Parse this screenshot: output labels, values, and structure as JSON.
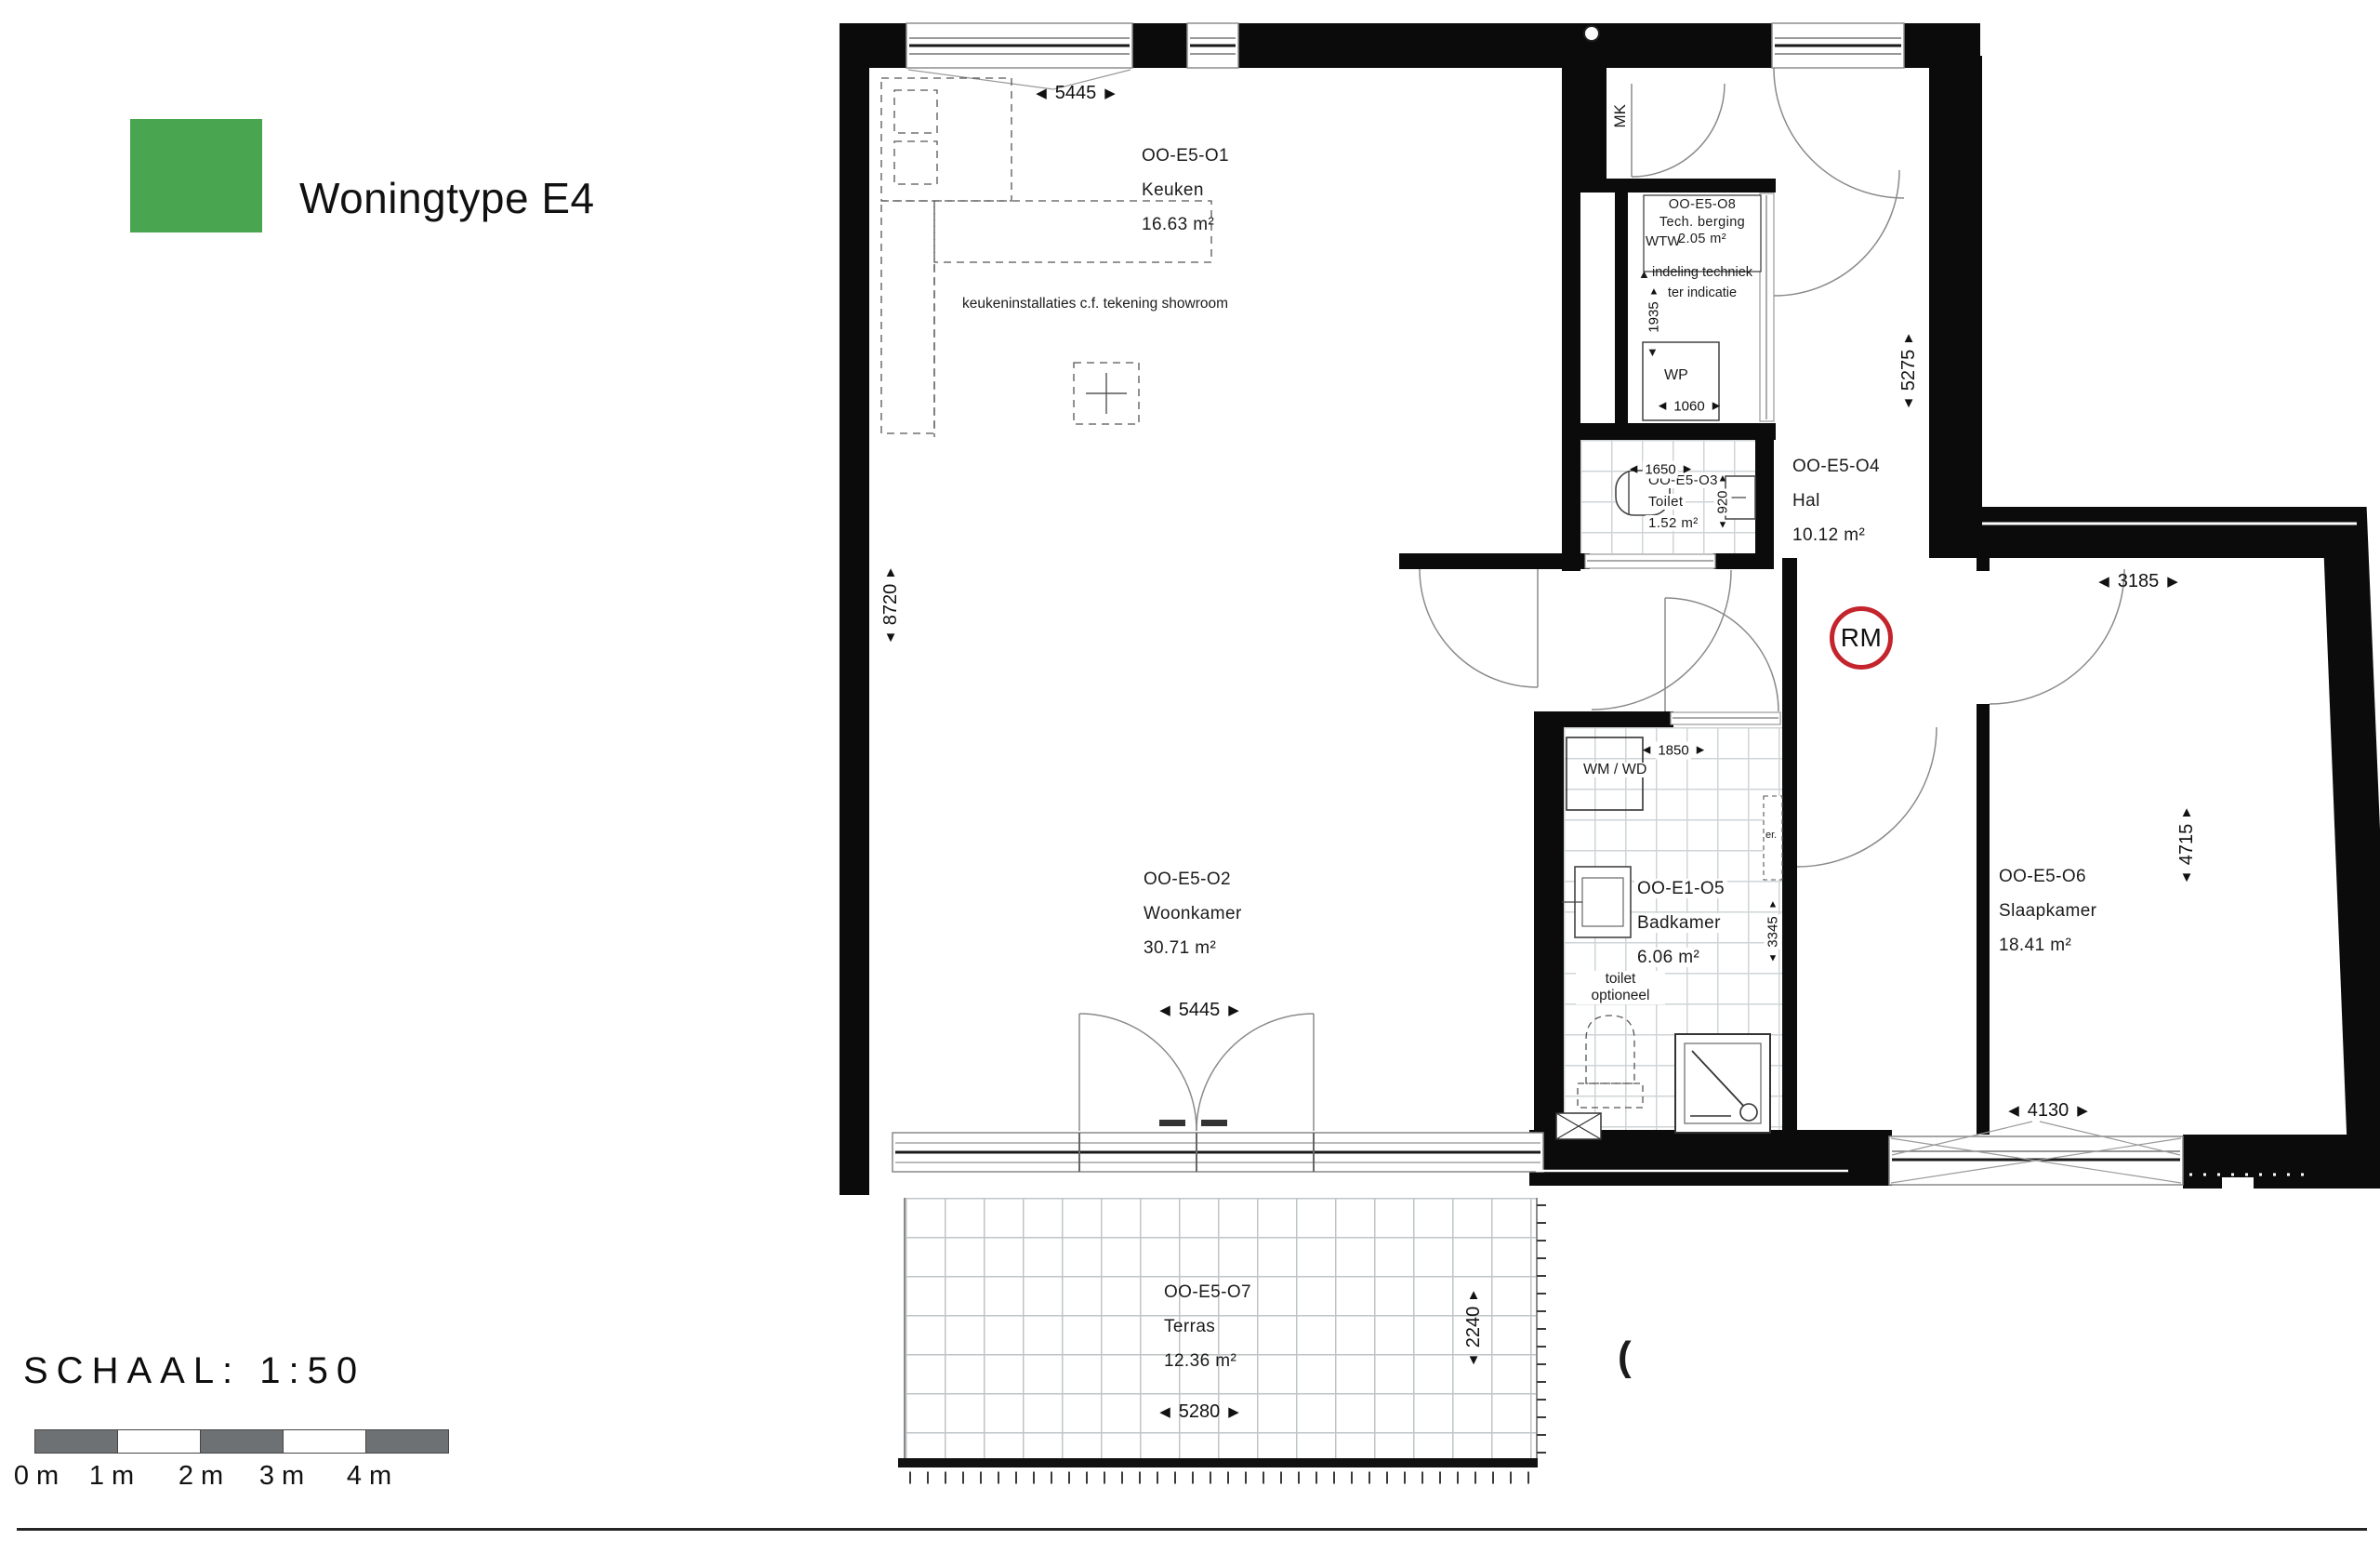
{
  "header": {
    "title": "Woningtype E4"
  },
  "colors": {
    "legend_green": "#4aa551",
    "rm_red": "#c4242c"
  },
  "scalebar": {
    "label": "SCHAAL: 1:50",
    "ticks": [
      "0 m",
      "1 m",
      "2 m",
      "3 m",
      "4 m"
    ]
  },
  "rooms": {
    "keuken": {
      "code": "OO-E5-O1",
      "name": "Keuken",
      "area": "16.63 m²",
      "note": "keukeninstallaties c.f. tekening showroom"
    },
    "woonkamer": {
      "code": "OO-E5-O2",
      "name": "Woonkamer",
      "area": "30.71 m²"
    },
    "toilet": {
      "code": "OO-E5-O3",
      "name": "Toilet",
      "area": "1.52 m²"
    },
    "hal": {
      "code": "OO-E5-O4",
      "name": "Hal",
      "area": "10.12 m²"
    },
    "badkamer": {
      "code": "OO-E1-O5",
      "name": "Badkamer",
      "area": "6.06 m²",
      "note": "toilet optioneel"
    },
    "slaapkamer": {
      "code": "OO-E5-O6",
      "name": "Slaapkamer",
      "area": "18.41 m²"
    },
    "terras": {
      "code": "OO-E5-O7",
      "name": "Terras",
      "area": "12.36 m²"
    },
    "tech_berging": {
      "code": "OO-E5-O8",
      "name": "Tech. berging",
      "area": "2.05 m²",
      "note": "indeling techniek ter indicatie"
    }
  },
  "dimensions": {
    "keuken_width": "5445",
    "facade_height": "8720",
    "woonkamer_width": "5445",
    "toilet_width": "1650",
    "toilet_depth": "920",
    "tech_height": "1935",
    "tech_width": "1060",
    "hal_height": "5275",
    "badkamer_width": "1850",
    "badkamer_depth": "3345",
    "slaapkamer_width": "3185",
    "slaapkamer_height": "4715",
    "slaapkamer_window": "4130",
    "terras_width": "5280",
    "terras_depth": "2240"
  },
  "markers": {
    "mk": "MK",
    "wtw": "WTW",
    "wp": "WP",
    "wm_wd": "WM / WD",
    "er": "er.",
    "rm": "RM",
    "section": "("
  }
}
